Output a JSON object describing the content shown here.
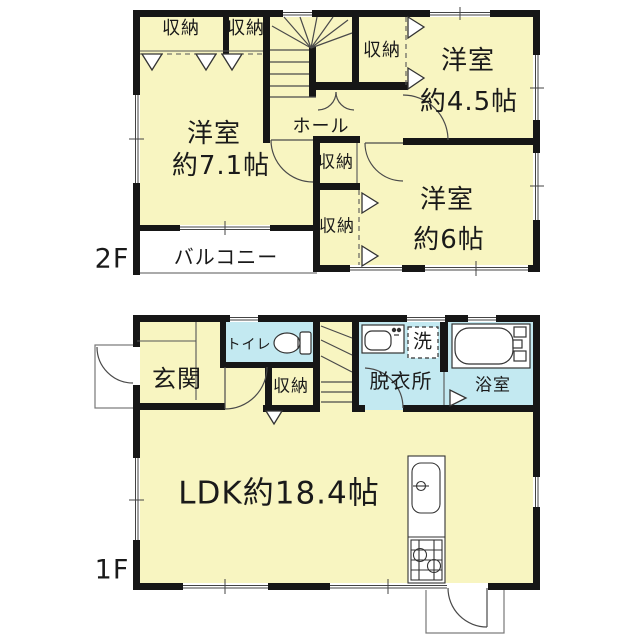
{
  "floors": {
    "f2": {
      "label": "2F",
      "closet1": "収納",
      "closet2": "収納",
      "closet3": "収納",
      "closet4": "収納",
      "closet5": "収納",
      "hall": "ホール",
      "room71": {
        "name": "洋室",
        "size": "約7.1帖"
      },
      "room45": {
        "name": "洋室",
        "size": "約4.5帖"
      },
      "room6": {
        "name": "洋室",
        "size": "約6帖"
      },
      "balcony": "バルコニー"
    },
    "f1": {
      "label": "1F",
      "entrance": "玄関",
      "toilet": "トイレ",
      "closet": "収納",
      "dressing": "脱衣所",
      "laundry": "洗",
      "bath": "浴室",
      "ldk": "LDK約18.4帖"
    }
  },
  "colors": {
    "room_fill": "#F8F5C1",
    "wet_area_fill": "#C3E9F1",
    "wall": "#161616",
    "background": "#FFFFFF"
  }
}
